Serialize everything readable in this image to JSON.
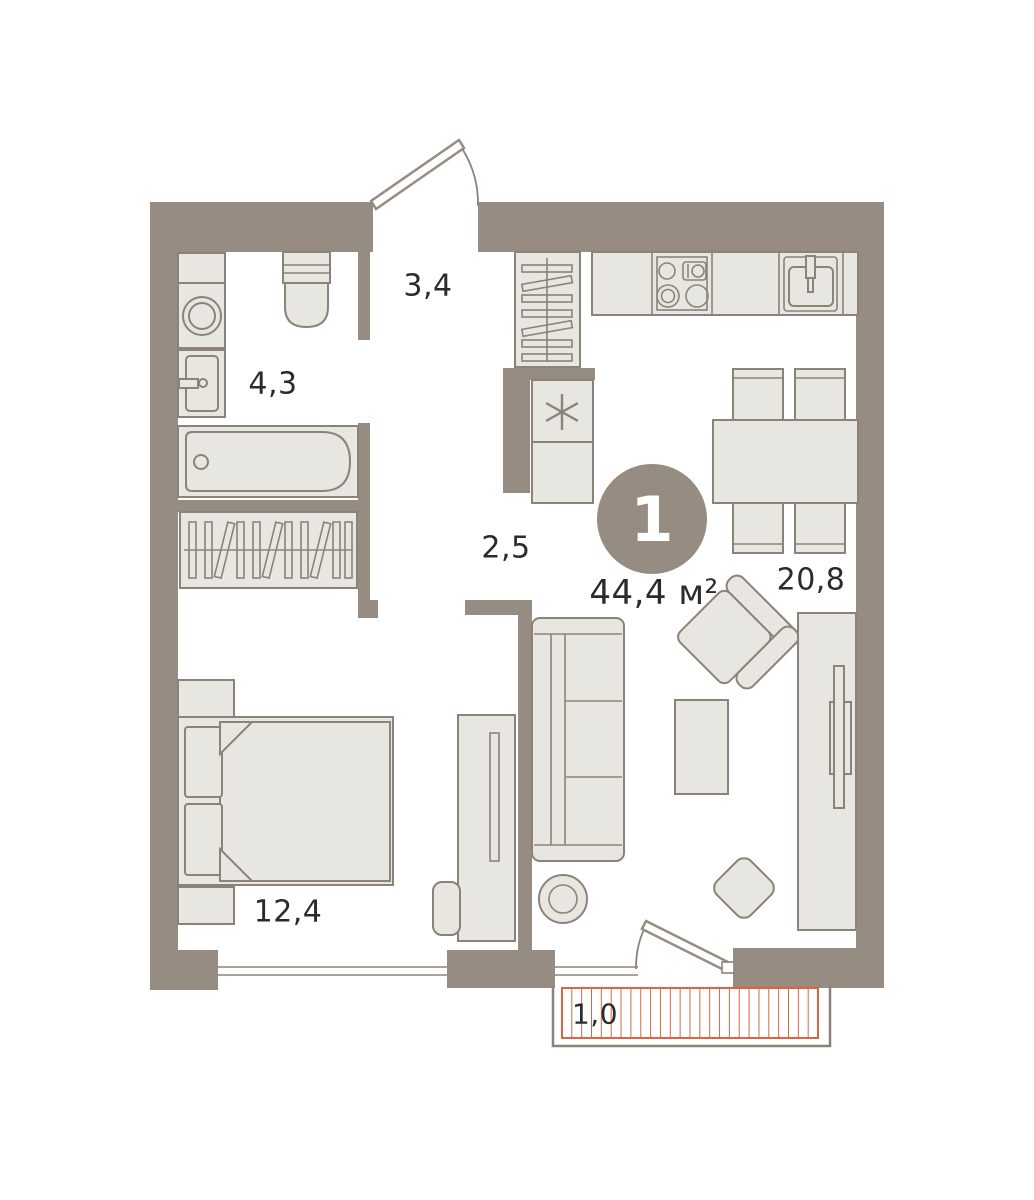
{
  "plan": {
    "badge_number": "1",
    "total_area": "44,4 м²",
    "rooms": [
      {
        "name": "hallway",
        "area": "3,4"
      },
      {
        "name": "bathroom",
        "area": "4,3"
      },
      {
        "name": "corridor",
        "area": "2,5"
      },
      {
        "name": "kitchen-living-room",
        "area": "20,8"
      },
      {
        "name": "bedroom",
        "area": "12,4"
      },
      {
        "name": "balcony",
        "area": "1,0"
      }
    ],
    "colors": {
      "wall": "#968c82",
      "furniture_fill": "#e8e6e1",
      "furniture_stroke": "#8b8379",
      "balcony_hatch": "#d96542",
      "text": "#2b2b2b",
      "background": "#ffffff",
      "badge_text": "#ffffff"
    }
  }
}
